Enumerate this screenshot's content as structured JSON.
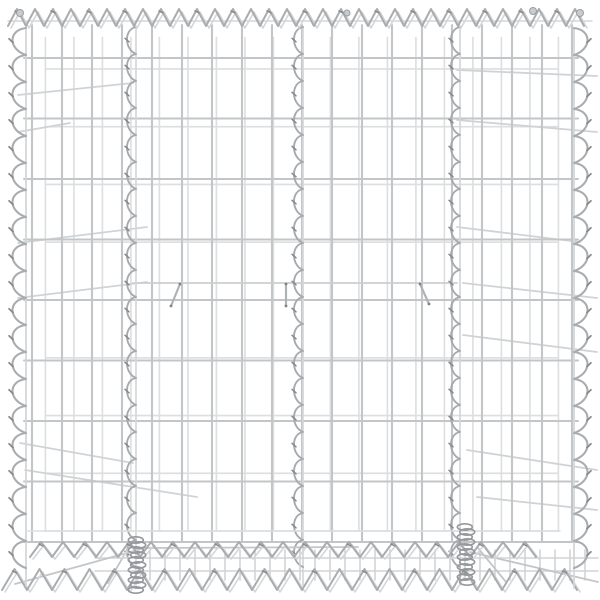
{
  "scene": {
    "alt": "Silver galvanized steel gabion wire basket with spiral bindings, product photo on white background",
    "canvas": {
      "w": 600,
      "h": 600,
      "background": "#ffffff"
    }
  },
  "palette": {
    "wire_front": "#c3c6c8",
    "wire_back": "#dcdedf",
    "wire_diag": "#d0d3d5",
    "brace": "#ccced0",
    "spiral_main": "#aaadb0",
    "spiral_soft": "#d4d6d8",
    "spiral_dark": "#85888b",
    "internal_spiral": "#a7aaad",
    "coil": "#96999c",
    "hook": "#b0b3b6",
    "hook_tip": "#7e8184",
    "blob_fill": "#c9ccce",
    "blob_stroke": "#9b9ea1"
  },
  "front_mesh": {
    "left": 32,
    "right": 572,
    "top": 25,
    "bottom": 542,
    "v_spacing": 30,
    "h_start": 58,
    "h_spacing": 60.5,
    "h_count": 9
  },
  "back_mesh": {
    "parallax_x": 0.05,
    "parallax_y": 0.045,
    "center_x": 300,
    "center_y": 300
  },
  "top_spiral": {
    "x1": 8,
    "x2": 592,
    "apex_y": 9,
    "base_y": 26,
    "pitch": 18,
    "rail_y": 21
  },
  "edge_spirals": {
    "left": {
      "base_x": 26,
      "bulge_x": 8,
      "y1": 28,
      "y2": 586,
      "pitch": 27
    },
    "right": {
      "base_x": 574,
      "bulge_x": 592,
      "y1": 28,
      "y2": 588,
      "pitch": 27
    }
  },
  "internal_spirals": {
    "xs": [
      133,
      300,
      457
    ],
    "y1": 27,
    "y2": 585,
    "pitch": 27,
    "bulge_w": 9
  },
  "bottom_spirals": [
    {
      "x1": 30,
      "x2": 542,
      "apex_y": 542,
      "base_y": 557,
      "pitch": 22
    },
    {
      "x1": 2,
      "x2": 598,
      "apex_y": 569,
      "base_y": 590,
      "pitch": 25
    }
  ],
  "bottom_band": {
    "v_x1": 150,
    "v_x2": 596,
    "v_step": 15,
    "v_y1": 550,
    "v_y2": 580,
    "h_lines": [
      558,
      571
    ],
    "h_x1": 95,
    "h_x2": 598,
    "back_rail_y": 531,
    "back_rail_x1": 28,
    "back_rail_x2": 560
  },
  "coils": [
    {
      "x": 137,
      "y1": 540,
      "y2": 590
    },
    {
      "x": 466,
      "y1": 527,
      "y2": 586
    }
  ],
  "brace_wire": {
    "y": 283,
    "x1": 133,
    "x2": 457
  },
  "hooks": [
    {
      "x1": 180,
      "y1": 284,
      "x2": 171,
      "y2": 306
    },
    {
      "x1": 286,
      "y1": 284,
      "x2": 286,
      "y2": 306
    },
    {
      "x1": 420,
      "y1": 284,
      "x2": 429,
      "y2": 304
    }
  ],
  "side_diagonals": [
    [
      18,
      95,
      133,
      83
    ],
    [
      18,
      132,
      70,
      123
    ],
    [
      18,
      243,
      147,
      227
    ],
    [
      18,
      298,
      147,
      282
    ],
    [
      20,
      443,
      133,
      463
    ],
    [
      25,
      470,
      197,
      497
    ],
    [
      457,
      70,
      597,
      76
    ],
    [
      457,
      120,
      597,
      132
    ],
    [
      457,
      227,
      580,
      242
    ],
    [
      463,
      283,
      597,
      298
    ],
    [
      463,
      335,
      597,
      352
    ],
    [
      467,
      450,
      597,
      470
    ],
    [
      477,
      497,
      597,
      510
    ]
  ],
  "bottom_diagonals": [
    [
      15,
      584,
      145,
      548
    ],
    [
      145,
      548,
      358,
      547
    ],
    [
      470,
      552,
      598,
      582
    ],
    [
      130,
      545,
      108,
      583
    ],
    [
      478,
      548,
      506,
      582
    ]
  ],
  "blobs": [
    {
      "x": 20,
      "y": 13,
      "r": 3.5
    },
    {
      "x": 347,
      "y": 13,
      "r": 3.0
    },
    {
      "x": 533,
      "y": 11,
      "r": 3.5
    },
    {
      "x": 580,
      "y": 13,
      "r": 3.5
    }
  ]
}
